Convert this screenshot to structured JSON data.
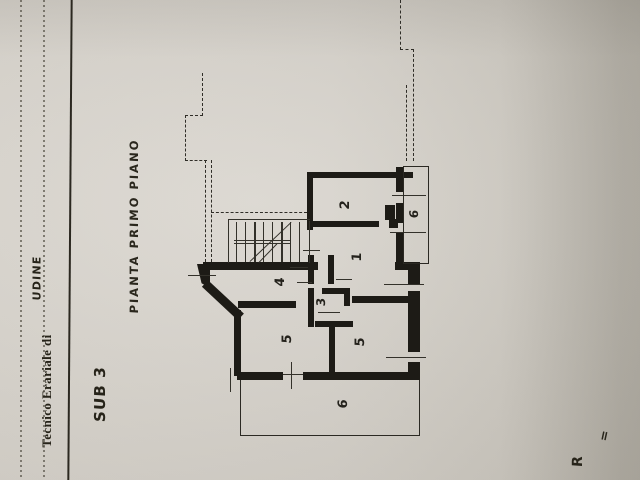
{
  "document": {
    "form_header": {
      "printed_label": "Tecnico Erariale di",
      "office_value": "UDINE"
    },
    "annotations": {
      "sub_label": "SUB 3",
      "plan_title": "PIANTA PRIMO PIANO",
      "partial_text": "R",
      "equals_mark": "="
    },
    "colors": {
      "paper": "#d7d3cc",
      "ink": "#1d1b16",
      "thin_line": "#33312a"
    }
  },
  "plan": {
    "room_labels": [
      {
        "text": "2",
        "cx": 345,
        "cy": 205,
        "size": 13
      },
      {
        "text": "1",
        "cx": 357,
        "cy": 257,
        "size": 13
      },
      {
        "text": "6",
        "cx": 414,
        "cy": 214,
        "size": 12
      },
      {
        "text": "4",
        "cx": 280,
        "cy": 282,
        "size": 13
      },
      {
        "text": "3",
        "cx": 321,
        "cy": 302,
        "size": 12
      },
      {
        "text": "5",
        "cx": 287,
        "cy": 339,
        "size": 13
      },
      {
        "text": "5",
        "cx": 360,
        "cy": 342,
        "size": 13
      },
      {
        "text": "6",
        "cx": 343,
        "cy": 404,
        "size": 13
      }
    ],
    "walls": [
      [
        307,
        172,
        106,
        6
      ],
      [
        307,
        172,
        6,
        58
      ],
      [
        313,
        221,
        66,
        6
      ],
      [
        389,
        219,
        9,
        9
      ],
      [
        396,
        167,
        8,
        25
      ],
      [
        396,
        203,
        8,
        20
      ],
      [
        396,
        233,
        8,
        31
      ],
      [
        395,
        262,
        25,
        8
      ],
      [
        408,
        270,
        12,
        14
      ],
      [
        408,
        291,
        12,
        61
      ],
      [
        408,
        362,
        12,
        18
      ],
      [
        237,
        372,
        46,
        8
      ],
      [
        303,
        372,
        117,
        8
      ],
      [
        203,
        262,
        115,
        8
      ],
      [
        308,
        255,
        6,
        29
      ],
      [
        328,
        255,
        6,
        29
      ],
      [
        203,
        262,
        7,
        22
      ],
      [
        234,
        310,
        7,
        66
      ],
      [
        308,
        288,
        6,
        39
      ],
      [
        322,
        288,
        22,
        6
      ],
      [
        344,
        288,
        6,
        18
      ],
      [
        315,
        321,
        38,
        6
      ],
      [
        329,
        321,
        6,
        56
      ],
      [
        238,
        301,
        58,
        7
      ],
      [
        352,
        296,
        62,
        7
      ],
      [
        385,
        205,
        10,
        15
      ]
    ],
    "wall_triangles": [
      [
        197,
        264,
        13,
        24
      ]
    ],
    "diagonal_walls": [
      [
        205,
        279,
        49,
        43,
        9
      ]
    ],
    "thin_lines": [
      [
        228,
        219,
        82,
        1.3
      ],
      [
        228,
        219,
        1.3,
        44
      ],
      [
        309,
        221,
        1.3,
        42
      ],
      [
        236,
        222,
        1.4,
        40
      ],
      [
        245,
        222,
        1.4,
        40
      ],
      [
        254,
        222,
        2.4,
        40
      ],
      [
        263,
        222,
        1.4,
        40
      ],
      [
        272,
        222,
        1.4,
        40
      ],
      [
        281,
        222,
        2.4,
        40
      ],
      [
        290,
        222,
        1.4,
        40
      ],
      [
        299,
        222,
        1.4,
        40
      ],
      [
        234,
        240,
        57,
        1.2
      ],
      [
        234,
        243,
        57,
        1.2
      ],
      [
        283,
        374,
        20,
        1.4
      ],
      [
        291,
        362,
        1.4,
        27
      ],
      [
        188,
        275,
        28,
        1.4
      ],
      [
        384,
        284,
        40,
        1.4
      ],
      [
        386,
        357,
        40,
        1.4
      ],
      [
        392,
        195,
        34,
        1.4
      ],
      [
        390,
        232,
        36,
        1.4
      ],
      [
        290,
        267,
        18,
        1.4
      ],
      [
        297,
        282,
        15,
        1.4
      ],
      [
        336,
        279,
        16,
        1.4
      ],
      [
        303,
        250,
        17,
        1.4
      ],
      [
        318,
        312,
        22,
        1.4
      ],
      [
        230,
        368,
        1.4,
        24
      ]
    ],
    "stair_diagonals": [
      [
        250,
        261,
        57,
        -43.5,
        1.4
      ],
      [
        259,
        262,
        26,
        -46,
        1.4
      ]
    ],
    "dashed_lines": [
      [
        202,
        73,
        43,
        "v"
      ],
      [
        185,
        115,
        18,
        "h"
      ],
      [
        185,
        115,
        46,
        "v"
      ],
      [
        185,
        160,
        22,
        "h"
      ],
      [
        205,
        160,
        102,
        "v"
      ],
      [
        211,
        160,
        102,
        "v"
      ],
      [
        211,
        212,
        96,
        "h"
      ],
      [
        400,
        0,
        50,
        "v"
      ],
      [
        400,
        49,
        14,
        "h"
      ],
      [
        413,
        49,
        112,
        "v"
      ],
      [
        406,
        85,
        76,
        "v"
      ]
    ],
    "balcony_outlines": [
      {
        "rect": [
          403,
          166,
          26,
          98
        ],
        "sides": "trbl"
      },
      {
        "rect": [
          240,
          380,
          180,
          56
        ],
        "sides": "rbl"
      }
    ]
  }
}
